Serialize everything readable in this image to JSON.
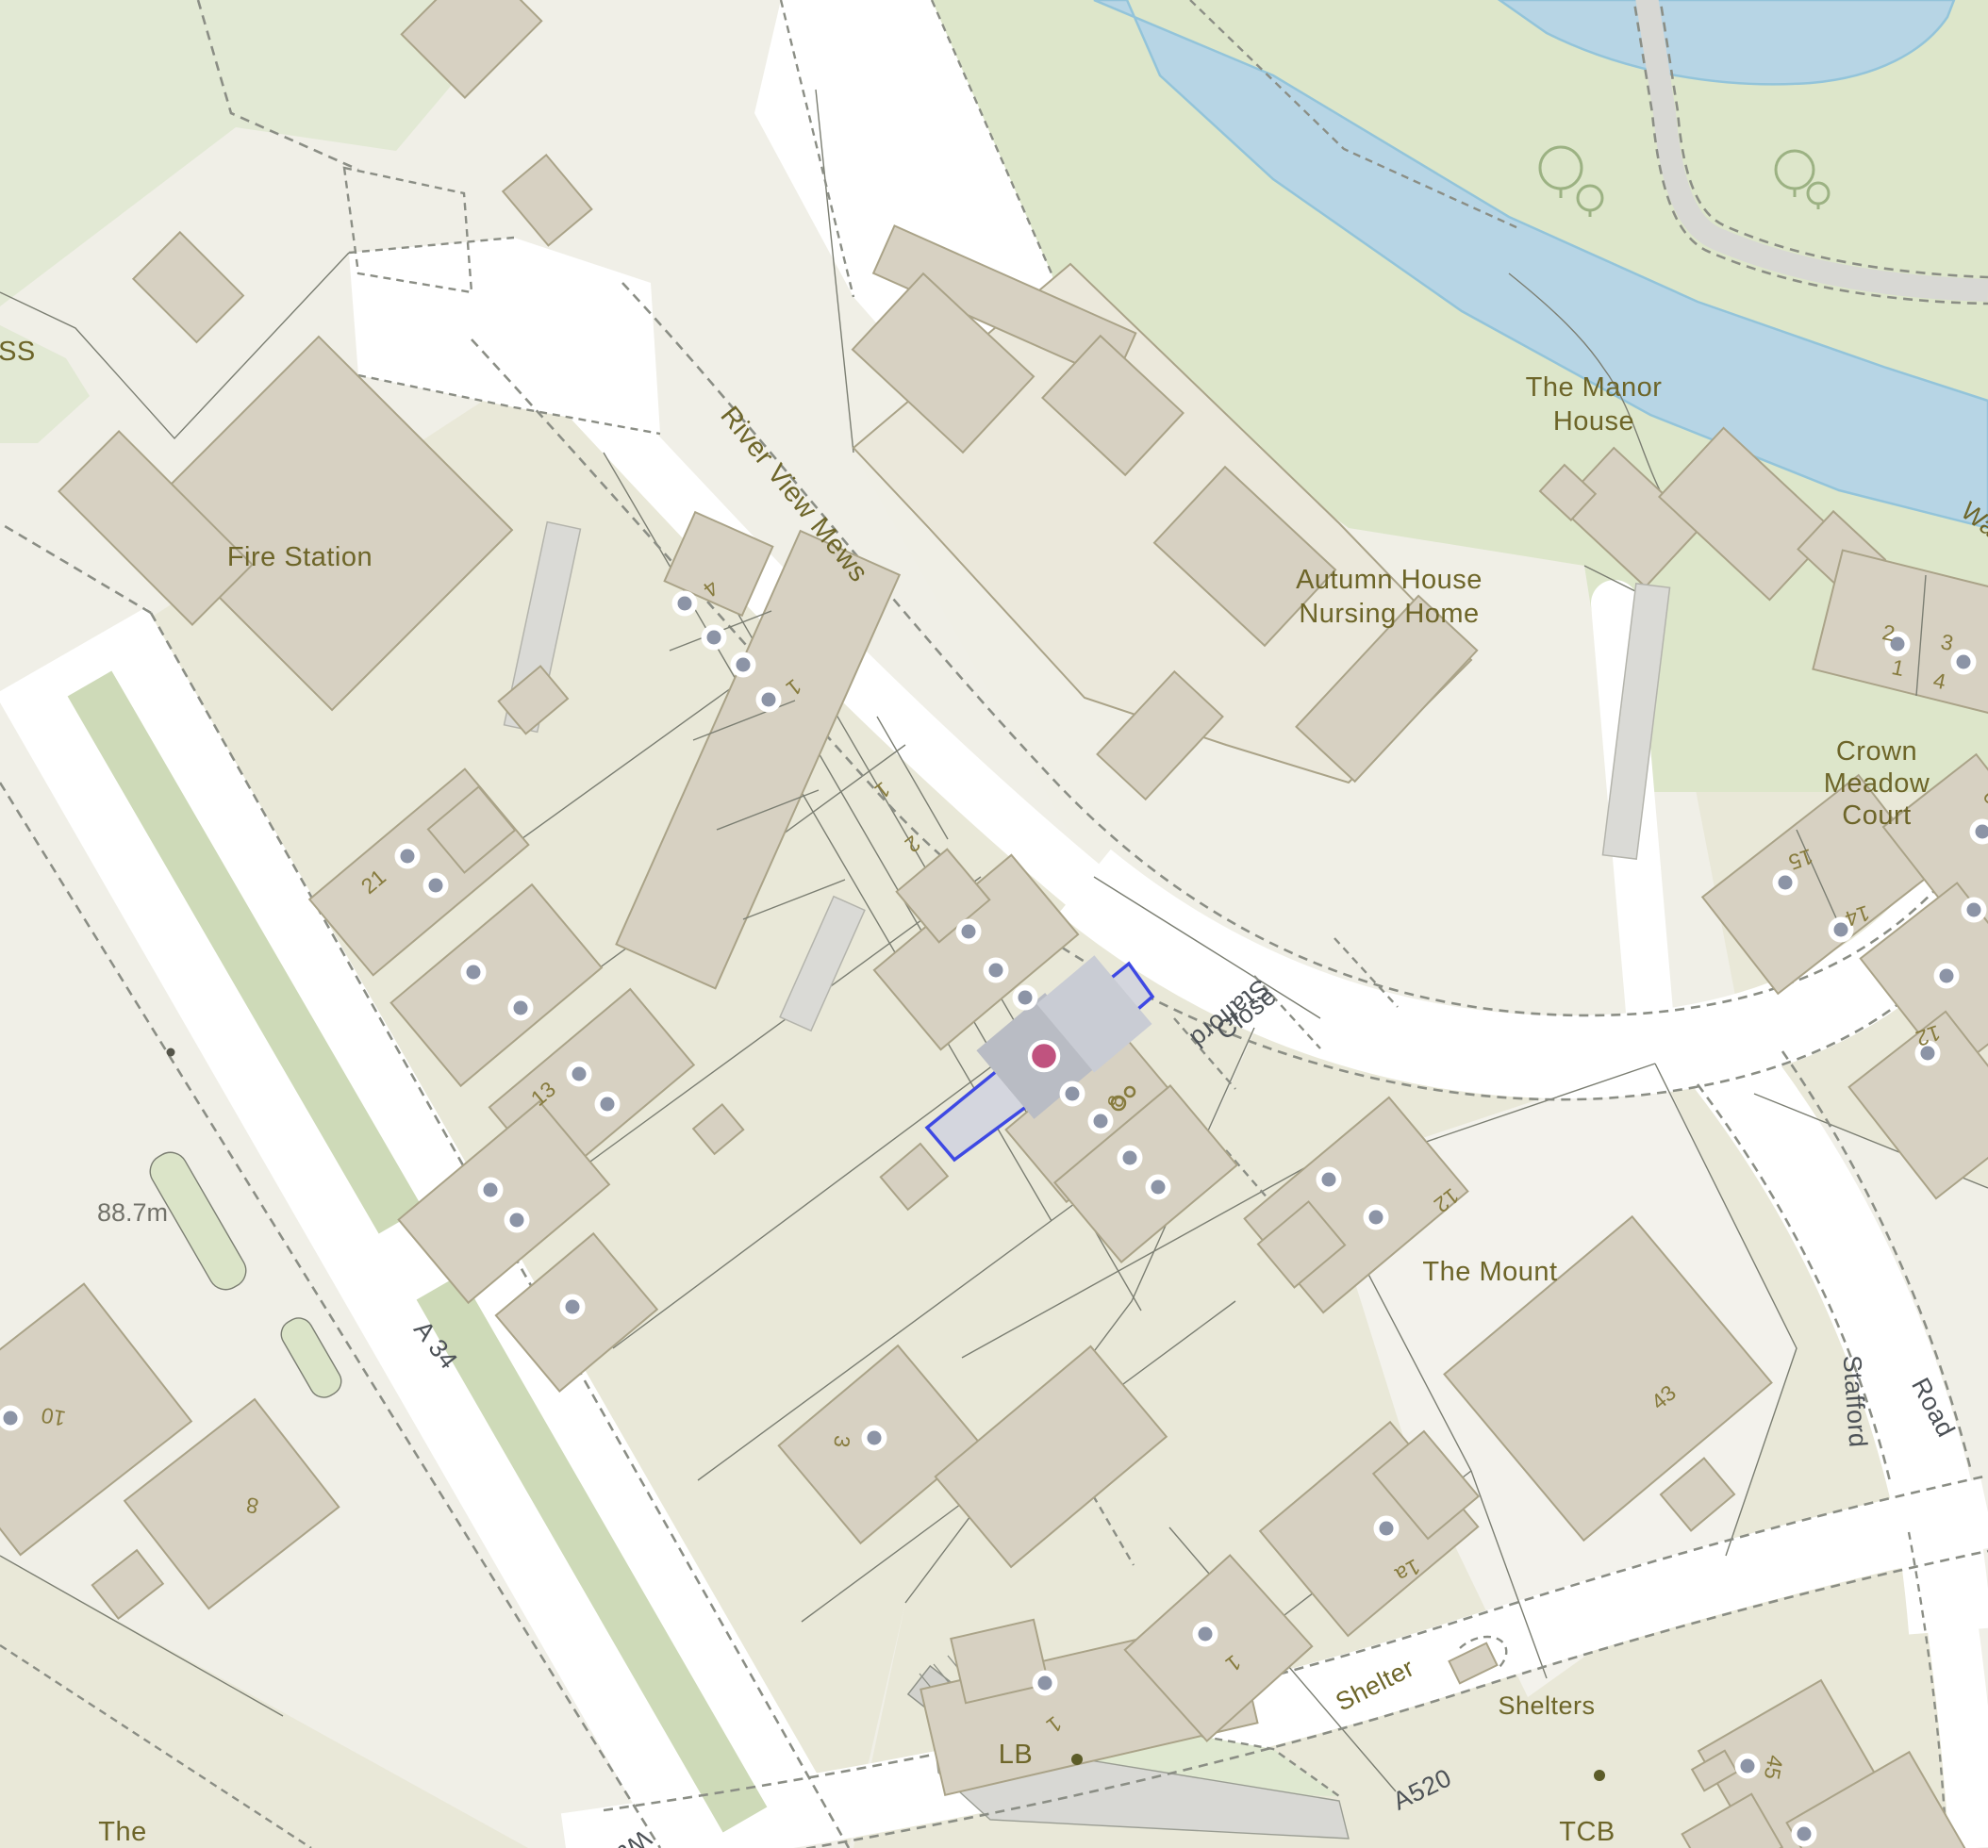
{
  "map": {
    "labels": {
      "ess": "ESS",
      "fire_station": "Fire Station",
      "river_view_mews": "River View Mews",
      "manor_1": "The Manor",
      "manor_2": "House",
      "autumn_1": "Autumn House",
      "autumn_2": "Nursing Home",
      "cmc_1": "Crown",
      "cmc_2": "Meadow",
      "cmc_3": "Court",
      "the_mount": "The Mount",
      "shelter": "Shelter",
      "shelters": "Shelters",
      "tcb": "TCB",
      "lb": "LB",
      "the_partial": "The",
      "wal_partial": "Wal",
      "way_partial": "Way"
    },
    "roads": {
      "a34": "A 34",
      "a520": "A520",
      "stafford": "Stafford",
      "road": "Road",
      "stafford_close_1": "Stafford",
      "stafford_close_2": "Close"
    },
    "elevation": "88.7m",
    "house_numbers": [
      "4",
      "1",
      "1",
      "2",
      "21",
      "13",
      "8",
      "12",
      "2",
      "3",
      "1",
      "4",
      "6",
      "15",
      "14",
      "12",
      "10",
      "8",
      "3",
      "1a",
      "43",
      "45",
      "1",
      "1"
    ],
    "marker": {
      "type": "property-pin",
      "color": "#c0537f",
      "highlight_stroke": "#3e49e3"
    },
    "colors": {
      "land": "#f0efe7",
      "garden": "#e9e8d8",
      "green": "#e2e9d4",
      "green_river": "#dde6ca",
      "median": "#cedab8",
      "water": "#b7d5e5",
      "building": "#d7d1c2",
      "building_light": "#ebe8db",
      "road": "#ffffff",
      "place_text": "#6d6529",
      "road_text": "#4d5257",
      "number_text": "#877b3e",
      "address_dot": "#8c94a6"
    }
  }
}
